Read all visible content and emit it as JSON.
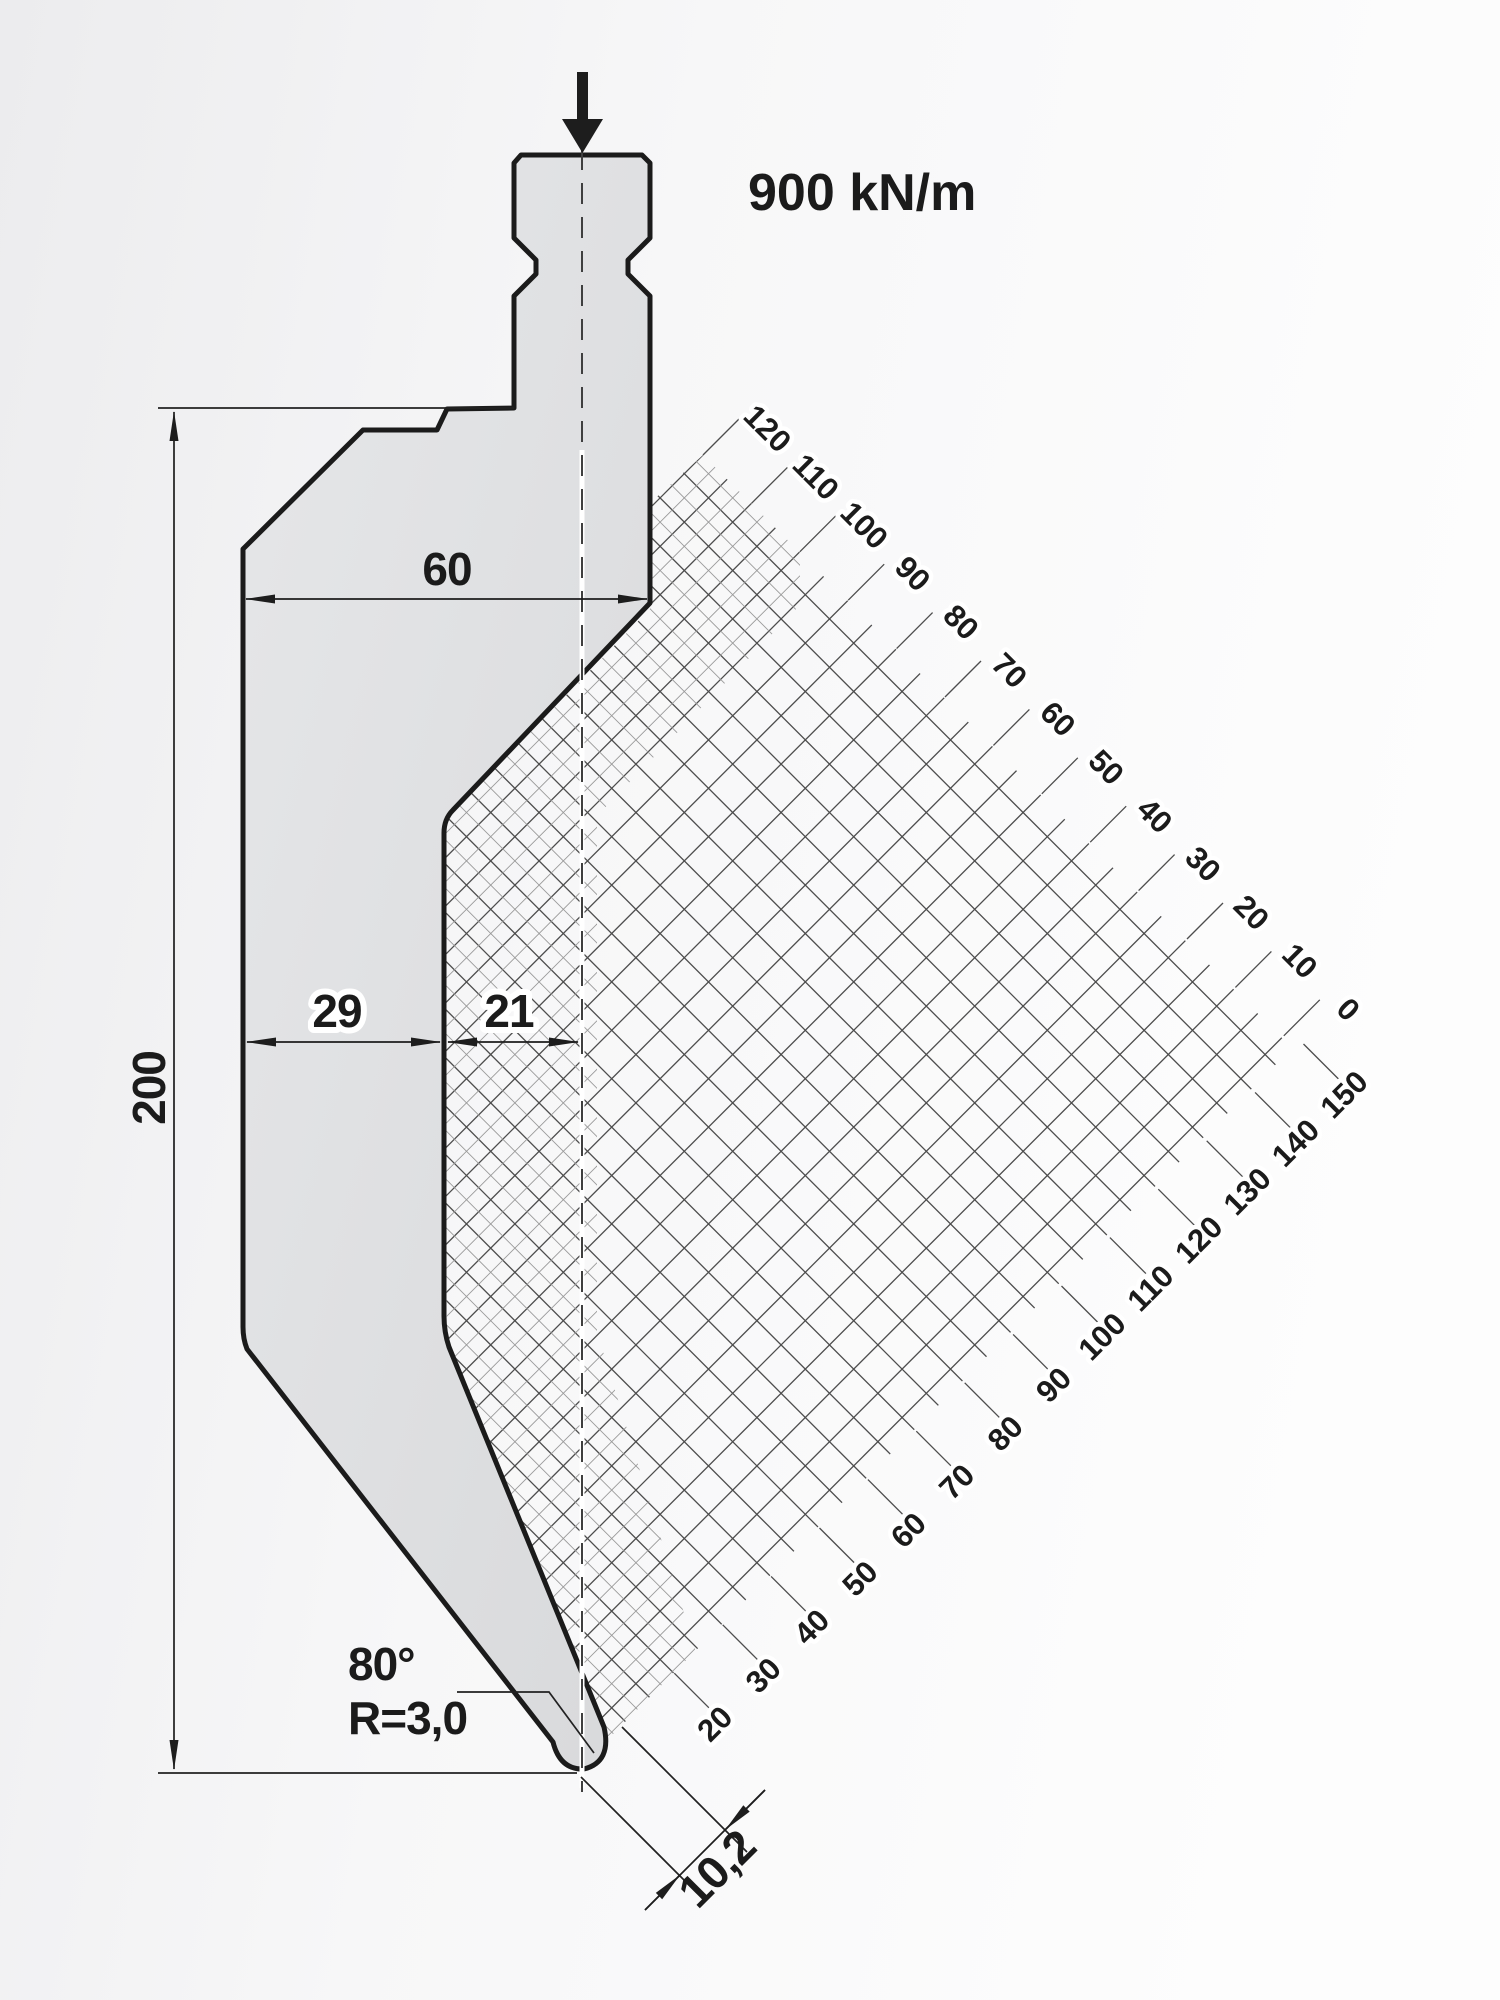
{
  "force": {
    "label": "900 kN/m"
  },
  "dimensions": {
    "top_width": "60",
    "total_height": "200",
    "body_left_width": "29",
    "tip_offset": "21",
    "tip_angle": "80°",
    "tip_radius": "R=3,0",
    "tip_width": "10,2"
  },
  "grid": {
    "top_scale": [
      "120",
      "110",
      "100",
      "90",
      "80",
      "70",
      "60",
      "50",
      "40",
      "30",
      "20",
      "10",
      "0"
    ],
    "bottom_scale": [
      "20",
      "30",
      "40",
      "50",
      "60",
      "70",
      "80",
      "90",
      "100",
      "110",
      "120",
      "130",
      "140",
      "150"
    ]
  }
}
